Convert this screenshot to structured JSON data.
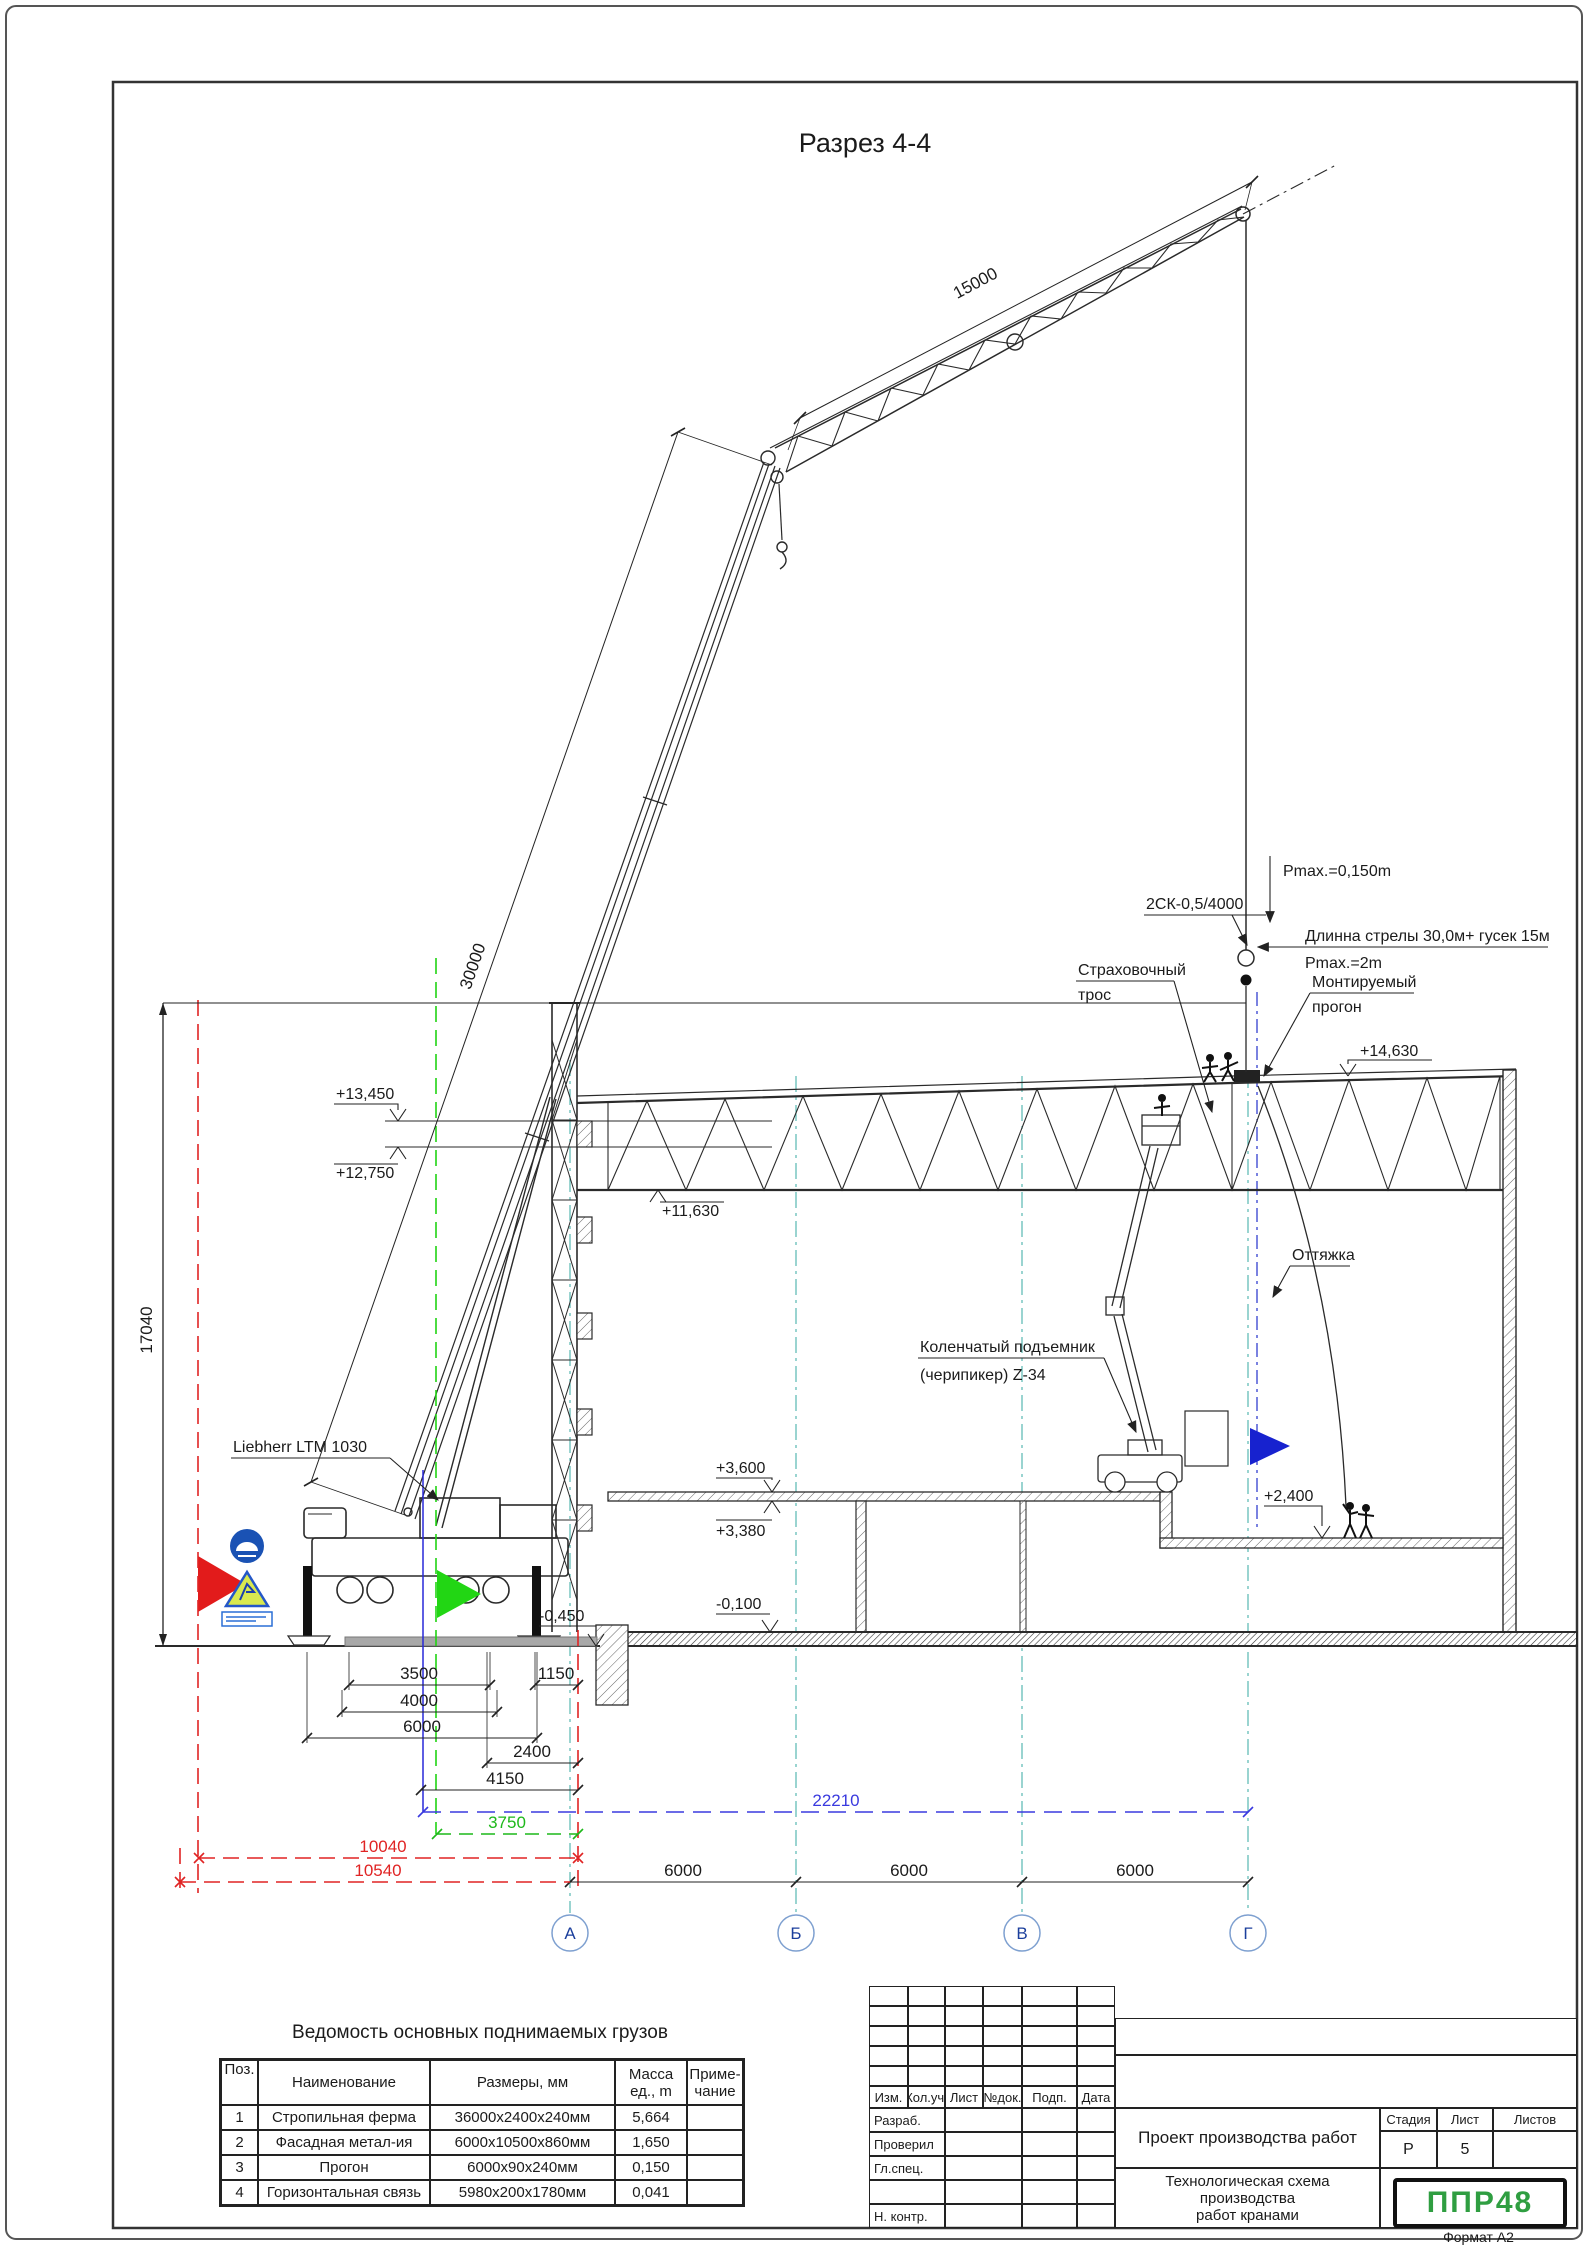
{
  "page": {
    "format": "Формат А2"
  },
  "drawing": {
    "title": "Разрез 4-4",
    "labels": {
      "crane": "Liebherr LTM 1030",
      "sling": "2СК-0,5/4000",
      "hook_load": "Pmax.=0,150m",
      "boom_config": "Длинна стрелы 30,0м+ гусек 15м",
      "boom_load": "Pmax.=2m",
      "safety_rope_1": "Страховочный",
      "safety_rope_2": "трос",
      "purlin_1": "Монтируемый",
      "purlin_2": "прогон",
      "guy": "Оттяжка",
      "lift_1": "Коленчатый подъемник",
      "lift_2": "(черипикер) Z-34"
    },
    "elevations": {
      "roof": "+14,630",
      "girt_top": "+13,450",
      "girt_bottom": "+12,750",
      "truss_bottom": "+11,630",
      "slab_top": "+3,600",
      "slab_bottom": "+3,380",
      "ground_floor": "-0,100",
      "pit_floor": "+2,400",
      "crane_ground": "-0,450"
    },
    "dimensions": {
      "boom": "30000",
      "jib": "15000",
      "height": "17040",
      "outriggers": "3500",
      "d1150": "1150",
      "d4000": "4000",
      "d6000": "6000",
      "d2400": "2400",
      "d4150": "4150",
      "d22210": "22210",
      "d3750": "3750",
      "d10040": "10040",
      "d10540": "10540",
      "bay1": "6000",
      "bay2": "6000",
      "bay3": "6000"
    },
    "axes": [
      "А",
      "Б",
      "В",
      "Г"
    ]
  },
  "icons": {
    "helmet_sign": "hard-hat-required-sign",
    "crane_warning_sign": "lifting-works-warning-sign",
    "caption_plate": "safety-caption-plate",
    "red_flag": "boundary-flag",
    "green_flag": "crane-axis-flag",
    "blue_flag": "work-zone-flag"
  },
  "colors": {
    "axis_grid": "#57b8b2",
    "dim_blue": "#3a3adf",
    "dim_green": "#1db81a",
    "dim_red": "#e02424",
    "flag_red": "#e21b1b",
    "flag_green": "#22d614",
    "flag_blue": "#1722cf",
    "logo_green": "#2f9e41"
  },
  "load_table": {
    "title": "Ведомость основных поднимаемых грузов",
    "headers": {
      "pos": "Поз.",
      "name": "Наименование",
      "size": "Размеры, мм",
      "mass_1": "Масса",
      "mass_2": "ед., m",
      "note_1": "Приме-",
      "note_2": "чание"
    },
    "rows": [
      {
        "pos": "1",
        "name": "Стропильная ферма",
        "size": "36000х2400х240мм",
        "mass": "5,664",
        "note": ""
      },
      {
        "pos": "2",
        "name": "Фасадная метал-ия",
        "size": "6000х10500х860мм",
        "mass": "1,650",
        "note": ""
      },
      {
        "pos": "3",
        "name": "Прогон",
        "size": "6000х90х240мм",
        "mass": "0,150",
        "note": ""
      },
      {
        "pos": "4",
        "name": "Горизонтальная связь",
        "size": "5980х200х1780мм",
        "mass": "0,041",
        "note": ""
      }
    ]
  },
  "title_block": {
    "revision_headers": [
      "Изм.",
      "Кол.уч.",
      "Лист",
      "№док.",
      "Подп.",
      "Дата"
    ],
    "row_labels": [
      "Разраб.",
      "Проверил",
      "Гл.спец.",
      "",
      "Н. контр."
    ],
    "project_title": "Проект производства работ",
    "doc_title_1": "Технологическая схема производства",
    "doc_title_2": "работ кранами",
    "stage_label": "Стадия",
    "sheet_label": "Лист",
    "sheets_label": "Листов",
    "stage": "Р",
    "sheet": "5",
    "sheets": "",
    "logo": "ППР48"
  }
}
